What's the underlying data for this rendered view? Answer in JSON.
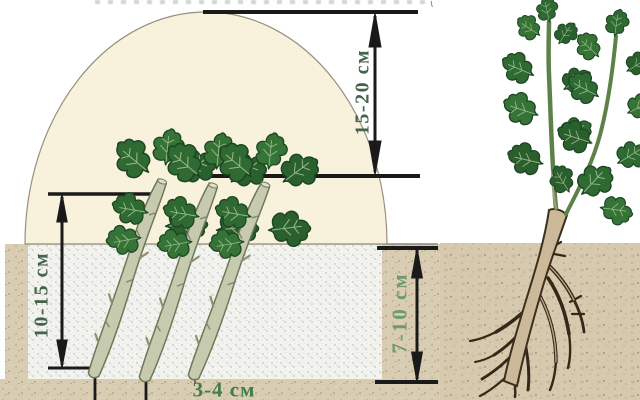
{
  "diagram": {
    "type": "planting-instruction-diagram",
    "annotations": {
      "cover_height": "15-20 см",
      "cutting_length": "10-15 см",
      "depth_below_surface": "7-10 см",
      "base_spacing": "3-4 см"
    },
    "counts": {
      "planted_cuttings": 3,
      "rooted_plants": 1
    },
    "colors": {
      "dome_fill": "#f8f1dc",
      "bed_fill": "#f2f2ee",
      "soil_fill": "#d8ccb2",
      "leaf_green": "#2f6a33",
      "stick_fill": "#c6cbaf",
      "trunk_fill": "#ccb999",
      "root_brown": "#33281a",
      "dimension_line": "#1a1a1a",
      "label_green_dark": "#43634a",
      "label_green_light": "#6f9b6c"
    }
  }
}
